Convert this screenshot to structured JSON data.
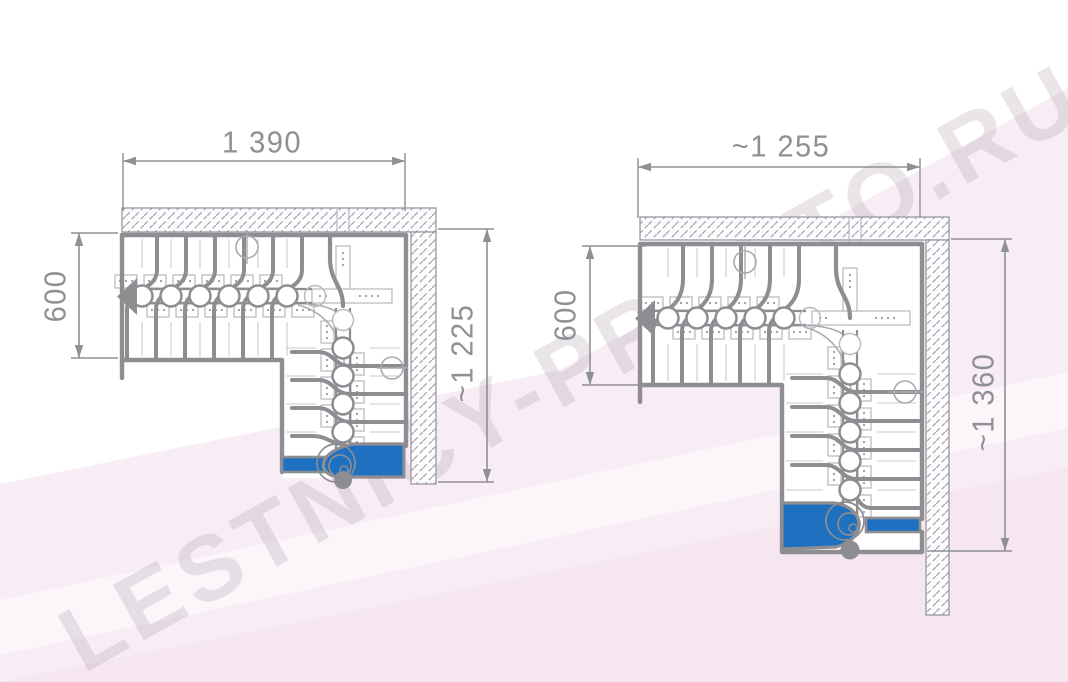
{
  "watermark": {
    "text": "LESTNICY-PROSTO.RU"
  },
  "plans": {
    "left": {
      "dim_top": "1 390",
      "dim_left": "600",
      "dim_right": "~1 225"
    },
    "right": {
      "dim_top": "~1 255",
      "dim_left": "600",
      "dim_right": "~1 360"
    }
  },
  "colors": {
    "line": "#8d8d92",
    "line_light": "#b7b7bd",
    "line_faint": "#c9c9ce",
    "hatch": "#a5a5ab",
    "wall_fill": "#fdfbfd",
    "dim": "#8f9095",
    "accent_blue": "#1e70c0",
    "background": "#ffffff",
    "background_pink": "#f6e8f1",
    "background_pink_deep": "#f2e0ec"
  }
}
